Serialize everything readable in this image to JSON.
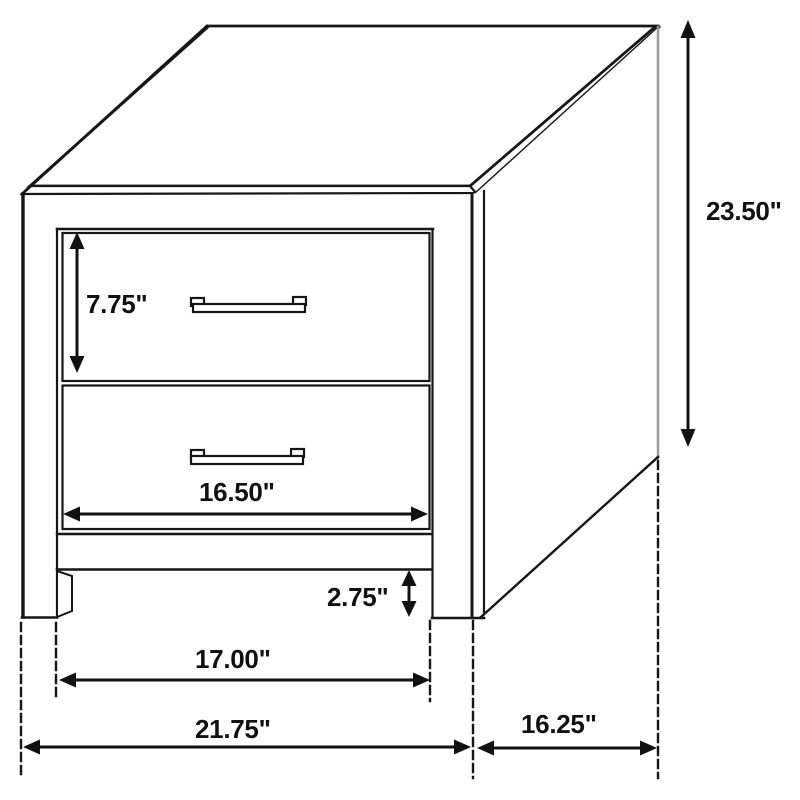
{
  "diagram": {
    "subject": "two-drawer-nightstand-dimension-diagram",
    "colors": {
      "line": "#161616",
      "background": "#ffffff",
      "label_text": "#111111",
      "back_edge_gray": "#9a9a9a"
    },
    "labels": {
      "drawer_height": "7.75\"",
      "overall_height": "23.50\"",
      "drawer_width": "16.50\"",
      "base_clearance": "2.75\"",
      "leg_span_width": "17.00\"",
      "overall_width": "21.75\"",
      "side_depth": "16.25\""
    }
  }
}
